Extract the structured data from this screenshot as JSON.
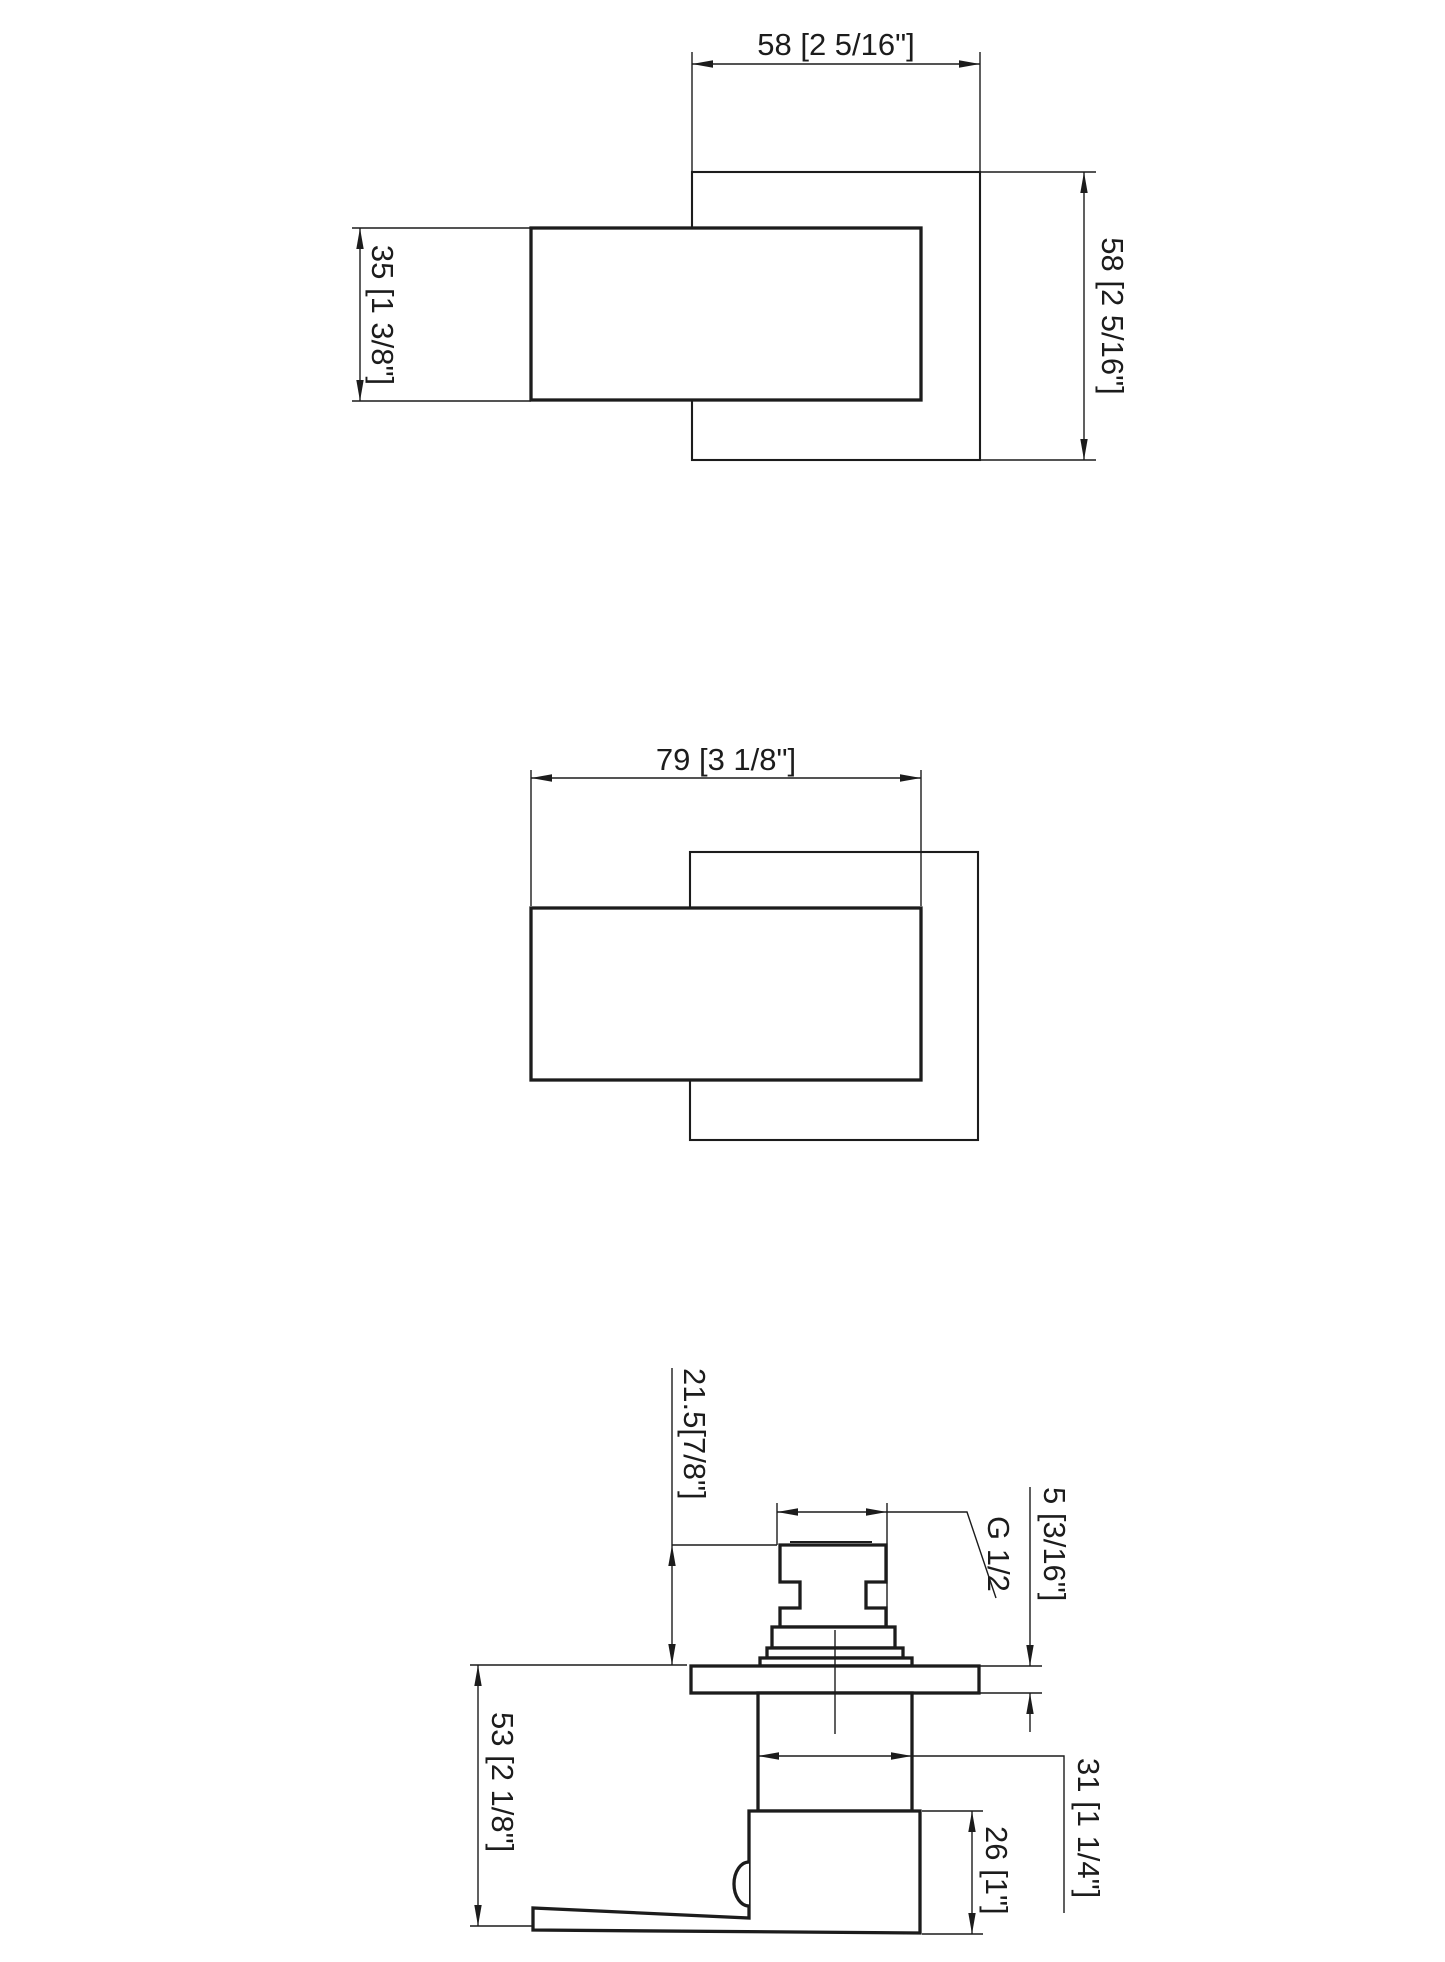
{
  "drawing": {
    "background_color": "#ffffff",
    "line_color": "#1c1c1c",
    "views": {
      "top": {
        "dims": {
          "plate_width": "58 [2 5/16\"]",
          "plate_height": "58 [2 5/16\"]",
          "handle_height": "35 [1 3/8\"]"
        }
      },
      "front": {
        "dims": {
          "handle_width": "79 [3 1/8\"]"
        }
      },
      "side": {
        "dims": {
          "cartridge_height": "21.5[7/8\"]",
          "thread": "G 1/2",
          "plate_thickness": "5 [3/16\"]",
          "total_depth": "53 [2 1/8\"]",
          "valve_body_width": "31 [1 1/4\"]",
          "handle_depth": "26 [1\"]"
        }
      }
    }
  }
}
